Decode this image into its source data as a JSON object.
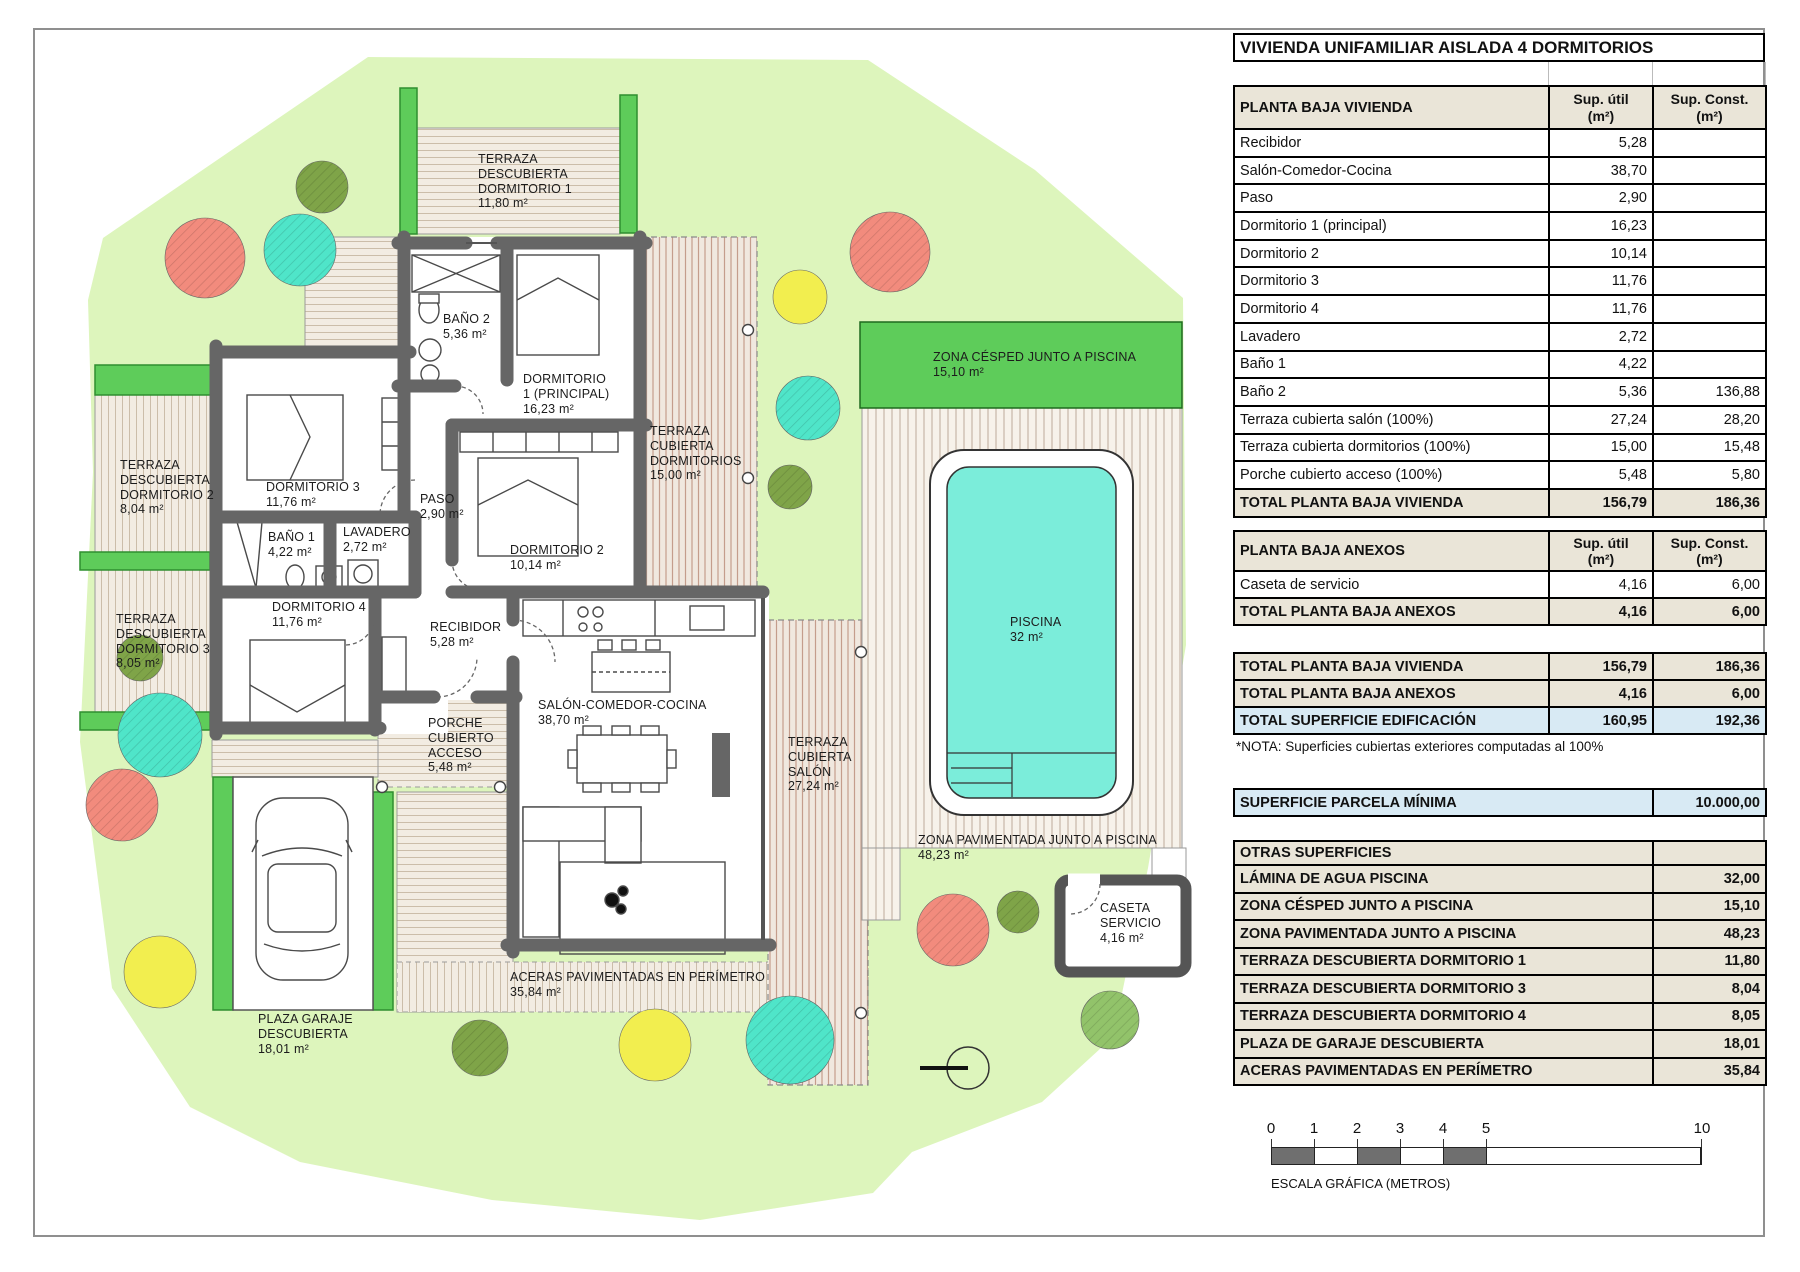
{
  "title": "VIVIENDA UNIFAMILIAR AISLADA 4 DORMITORIOS",
  "cols": {
    "util": "Sup. útil\n(m²)",
    "const": "Sup. Const.\n(m²)"
  },
  "t1": {
    "header": "PLANTA BAJA VIVIENDA",
    "rows": [
      {
        "label": "Recibidor",
        "util": "5,28",
        "const": ""
      },
      {
        "label": "Salón-Comedor-Cocina",
        "util": "38,70",
        "const": ""
      },
      {
        "label": "Paso",
        "util": "2,90",
        "const": ""
      },
      {
        "label": "Dormitorio 1 (principal)",
        "util": "16,23",
        "const": ""
      },
      {
        "label": "Dormitorio 2",
        "util": "10,14",
        "const": ""
      },
      {
        "label": "Dormitorio 3",
        "util": "11,76",
        "const": ""
      },
      {
        "label": "Dormitorio 4",
        "util": "11,76",
        "const": ""
      },
      {
        "label": "Lavadero",
        "util": "2,72",
        "const": ""
      },
      {
        "label": "Baño 1",
        "util": "4,22",
        "const": ""
      },
      {
        "label": "Baño 2",
        "util": "5,36",
        "const": "136,88"
      },
      {
        "label": "Terraza cubierta salón (100%)",
        "util": "27,24",
        "const": "28,20"
      },
      {
        "label": "Terraza cubierta dormitorios (100%)",
        "util": "15,00",
        "const": "15,48"
      },
      {
        "label": "Porche cubierto acceso (100%)",
        "util": "5,48",
        "const": "5,80"
      }
    ],
    "total": {
      "label": "TOTAL PLANTA BAJA VIVIENDA",
      "util": "156,79",
      "const": "186,36"
    }
  },
  "t2": {
    "header": "PLANTA BAJA ANEXOS",
    "rows": [
      {
        "label": "Caseta de servicio",
        "util": "4,16",
        "const": "6,00"
      }
    ],
    "total": {
      "label": "TOTAL PLANTA BAJA ANEXOS",
      "util": "4,16",
      "const": "6,00"
    }
  },
  "t3": {
    "rows": [
      {
        "label": "TOTAL PLANTA BAJA VIVIENDA",
        "util": "156,79",
        "const": "186,36"
      },
      {
        "label": "TOTAL PLANTA BAJA ANEXOS",
        "util": "4,16",
        "const": "6,00"
      },
      {
        "label": "TOTAL SUPERFICIE EDIFICACIÓN",
        "util": "160,95",
        "const": "192,36"
      }
    ]
  },
  "nota": "*NOTA: Superficies cubiertas exteriores computadas al 100%",
  "parcela": {
    "label": "SUPERFICIE PARCELA MÍNIMA",
    "value": "10.000,00"
  },
  "otras": {
    "header": "OTRAS SUPERFICIES",
    "rows": [
      {
        "label": "LÁMINA DE AGUA PISCINA",
        "value": "32,00"
      },
      {
        "label": "ZONA CÉSPED JUNTO A PISCINA",
        "value": "15,10"
      },
      {
        "label": "ZONA PAVIMENTADA JUNTO A PISCINA",
        "value": "48,23"
      },
      {
        "label": "TERRAZA DESCUBIERTA DORMITORIO 1",
        "value": "11,80"
      },
      {
        "label": "TERRAZA DESCUBIERTA DORMITORIO 3",
        "value": "8,04"
      },
      {
        "label": "TERRAZA DESCUBIERTA DORMITORIO 4",
        "value": "8,05"
      },
      {
        "label": "PLAZA DE GARAJE DESCUBIERTA",
        "value": "18,01"
      },
      {
        "label": "ACERAS PAVIMENTADAS EN PERÍMETRO",
        "value": "35,84"
      }
    ]
  },
  "plan": {
    "terraza_dorm1": "TERRAZA\nDESCUBIERTA\nDORMITORIO 1\n11,80 m²",
    "zona_cesped": "ZONA CÉSPED JUNTO A PISCINA\n15,10 m²",
    "dormitorio1": "DORMITORIO\n1 (PRINCIPAL)\n16,23 m²",
    "banio2": "BAÑO 2\n5,36 m²",
    "terraza_cub_dorm": "TERRAZA\nCUBIERTA\nDORMITORIOS\n15,00 m²",
    "terraza_dorm2": "TERRAZA\nDESCUBIERTA\nDORMITORIO 2\n8,04 m²",
    "dormitorio3": "DORMITORIO 3\n11,76 m²",
    "paso": "PASO\n2,90 m²",
    "banio1": "BAÑO 1\n4,22 m²",
    "lavadero": "LAVADERO\n2,72 m²",
    "dormitorio2": "DORMITORIO 2\n10,14 m²",
    "terraza_dorm3": "TERRAZA\nDESCUBIERTA\nDORMITORIO 3\n8,05 m²",
    "dormitorio4": "DORMITORIO 4\n11,76 m²",
    "recibidor": "RECIBIDOR\n5,28 m²",
    "porche": "PORCHE\nCUBIERTO\nACCESO\n5,48 m²",
    "salon": "SALÓN-COMEDOR-COCINA\n38,70 m²",
    "terraza_cub_salon": "TERRAZA\nCUBIERTA\nSALÓN\n27,24 m²",
    "piscina": "PISCINA\n32 m²",
    "zona_pav": "ZONA PAVIMENTADA JUNTO A PISCINA\n48,23 m²",
    "caseta": "CASETA\nSERVICIO\n4,16 m²",
    "aceras": "ACERAS PAVIMENTADAS EN PERÍMETRO\n35,84 m²",
    "plaza_garaje": "PLAZA GARAJE\nDESCUBIERTA\n18,01 m²"
  },
  "scale": {
    "ticks": [
      "0",
      "1",
      "2",
      "3",
      "4",
      "5",
      "10"
    ],
    "caption": "ESCALA GRÁFICA (METROS)"
  },
  "colors": {
    "garden": "#DDF5BC",
    "planter": "#5ECC5A",
    "pool": "#7BEDDA",
    "wall": "#666666",
    "beige_header": "#EAE5D8",
    "blue_highlight": "#D8EAF4",
    "tree_salmon": "#F28B7D",
    "tree_teal": "#4FE5C9",
    "tree_yellow": "#F2EE4F",
    "tree_green": "#7FA448"
  }
}
